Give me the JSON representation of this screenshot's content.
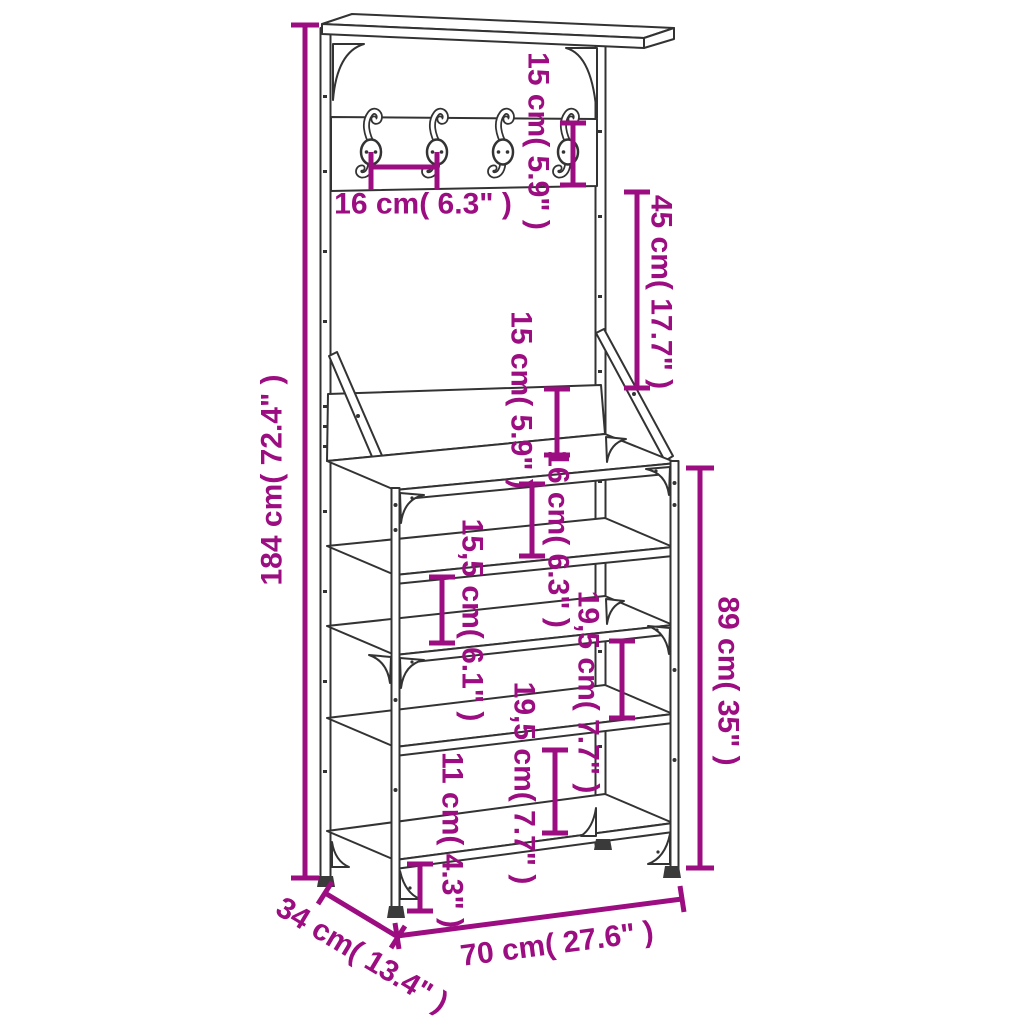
{
  "colors": {
    "dimension_accent": "#9B0D80",
    "line_art": "#333333",
    "background": "#FFFFFF"
  },
  "diagram": {
    "subject": "clothes-rack-with-shoe-storage-bench-dimension-drawing"
  },
  "dimensions": {
    "hook_board_height": "15 cm( 5.9\" )",
    "hook_spacing": "16 cm( 6.3\" )",
    "hook_board_to_panel": "45 cm( 17.7\" )",
    "back_panel_height": "15 cm( 5.9\" )",
    "overall_height": "184 cm( 72.4\" )",
    "bench_top_to_shelf2": "16 cm( 6.3\" )",
    "shelf2_to_shelf3": "15,5 cm( 6.1\" )",
    "shelf3_to_shelf4": "19,5 cm( 7.7\" )",
    "shelf4_to_shelf5": "19,5 cm( 7.7\" )",
    "shelf5_to_floor": "11 cm( 4.3\" )",
    "bench_height": "89 cm( 35\" )",
    "width": "70 cm( 27.6\" )",
    "depth": "34 cm( 13.4\" )"
  }
}
